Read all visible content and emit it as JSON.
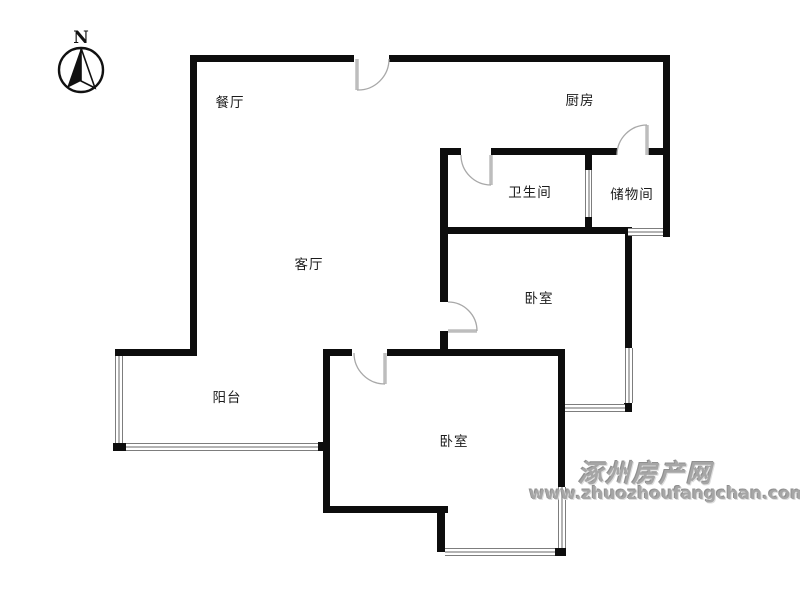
{
  "compass": {
    "label": "N"
  },
  "watermark": {
    "site_name": "涿州房产网",
    "site_url": "www.zhuozhoufangchan.com"
  },
  "colors": {
    "wall": "#0d0d0d",
    "window_frame": "#7d7d7d",
    "window_glass": "#b3b3b3",
    "door_leaf": "#bdbdbd",
    "door_arc": "#a8a8a8",
    "label_text": "#1c1c1c",
    "watermark_text": "#a6a6a6"
  },
  "rooms": [
    {
      "name": "dining-room",
      "label": "餐厅",
      "x": 230,
      "y": 101
    },
    {
      "name": "kitchen",
      "label": "厨房",
      "x": 580,
      "y": 99
    },
    {
      "name": "bathroom",
      "label": "卫生间",
      "x": 530,
      "y": 191
    },
    {
      "name": "storage-room",
      "label": "储物间",
      "x": 632,
      "y": 193
    },
    {
      "name": "living-room",
      "label": "客厅",
      "x": 309,
      "y": 263
    },
    {
      "name": "bedroom-east",
      "label": "卧室",
      "x": 539,
      "y": 297
    },
    {
      "name": "balcony",
      "label": "阳台",
      "x": 227,
      "y": 396
    },
    {
      "name": "bedroom-south",
      "label": "卧室",
      "x": 454,
      "y": 440
    }
  ],
  "plan": {
    "walls": [
      {
        "name": "top-wall-west",
        "x": 193,
        "y": 55,
        "w": 161,
        "h": 7
      },
      {
        "name": "top-wall-east",
        "x": 389,
        "y": 55,
        "w": 281,
        "h": 7
      },
      {
        "name": "west-wall",
        "x": 190,
        "y": 55,
        "w": 7,
        "h": 301
      },
      {
        "name": "east-outer-wall",
        "x": 663,
        "y": 55,
        "w": 7,
        "h": 182
      },
      {
        "name": "kitchen-wall-west",
        "x": 440,
        "y": 148,
        "w": 21,
        "h": 7
      },
      {
        "name": "kitchen-wall-mid",
        "x": 491,
        "y": 148,
        "w": 126,
        "h": 7
      },
      {
        "name": "kitchen-wall-east",
        "x": 647,
        "y": 148,
        "w": 23,
        "h": 7
      },
      {
        "name": "hall-divider-upper",
        "x": 440,
        "y": 148,
        "w": 8,
        "h": 154
      },
      {
        "name": "hall-divider-lower",
        "x": 440,
        "y": 331,
        "w": 8,
        "h": 25
      },
      {
        "name": "bath-south-wall",
        "x": 440,
        "y": 227,
        "w": 188,
        "h": 7
      },
      {
        "name": "bath-storage-divider-upper",
        "x": 585,
        "y": 152,
        "w": 7,
        "h": 18
      },
      {
        "name": "bath-storage-divider-lower",
        "x": 585,
        "y": 217,
        "w": 7,
        "h": 17
      },
      {
        "name": "bedroom-east-wall",
        "x": 625,
        "y": 227,
        "w": 7,
        "h": 121
      },
      {
        "name": "bay-corner-post",
        "x": 624,
        "y": 403,
        "w": 8,
        "h": 9
      },
      {
        "name": "balcony-north-wall",
        "x": 115,
        "y": 349,
        "w": 82,
        "h": 7
      },
      {
        "name": "south-wall-west",
        "x": 323,
        "y": 349,
        "w": 29,
        "h": 7
      },
      {
        "name": "south-wall-east",
        "x": 387,
        "y": 349,
        "w": 178,
        "h": 7
      },
      {
        "name": "mid-east-wall",
        "x": 558,
        "y": 349,
        "w": 7,
        "h": 138
      },
      {
        "name": "bedroom2-west-wall",
        "x": 323,
        "y": 349,
        "w": 7,
        "h": 164
      },
      {
        "name": "bedroom2-south-wall",
        "x": 323,
        "y": 506,
        "w": 125,
        "h": 7
      },
      {
        "name": "bay2-west-wall",
        "x": 437,
        "y": 506,
        "w": 8,
        "h": 46
      },
      {
        "name": "bay2-corner-post",
        "x": 555,
        "y": 548,
        "w": 11,
        "h": 8
      },
      {
        "name": "balcony-corner-sw",
        "x": 113,
        "y": 443,
        "w": 13,
        "h": 8
      },
      {
        "name": "balcony-corner-se",
        "x": 318,
        "y": 442,
        "w": 12,
        "h": 9
      }
    ],
    "windows": [
      {
        "name": "balcony-west-window",
        "x": 115,
        "y": 356,
        "w": 8,
        "h": 87,
        "dir": "v"
      },
      {
        "name": "balcony-south-window",
        "x": 126,
        "y": 443,
        "w": 192,
        "h": 8,
        "dir": "h"
      },
      {
        "name": "storage-south-window",
        "x": 628,
        "y": 228,
        "w": 35,
        "h": 8,
        "dir": "h"
      },
      {
        "name": "bay-east-window",
        "x": 625,
        "y": 348,
        "w": 8,
        "h": 55,
        "dir": "v"
      },
      {
        "name": "bay-south-window",
        "x": 565,
        "y": 404,
        "w": 60,
        "h": 8,
        "dir": "h"
      },
      {
        "name": "bay2-east-window",
        "x": 558,
        "y": 487,
        "w": 8,
        "h": 61,
        "dir": "v"
      },
      {
        "name": "bay2-south-window",
        "x": 445,
        "y": 548,
        "w": 110,
        "h": 8,
        "dir": "h"
      },
      {
        "name": "bath-storage-window",
        "x": 585,
        "y": 170,
        "w": 7,
        "h": 47,
        "dir": "v"
      }
    ],
    "doors": [
      {
        "name": "entry-door",
        "arc": "M 389 59 A 31 31 0 0 1 357 90",
        "leaf": "M 357 59 L 357 90"
      },
      {
        "name": "bathroom-door",
        "arc": "M 461 155 A 30 30 0 0 0 491 185",
        "leaf": "M 491 155 L 491 185"
      },
      {
        "name": "storage-door",
        "arc": "M 617 155 A 30 30 0 0 1 647 125",
        "leaf": "M 647 155 L 647 125"
      },
      {
        "name": "bedroom-east-door",
        "arc": "M 448 302 A 29 29 0 0 1 477 331",
        "leaf": "M 448 331 L 477 331"
      },
      {
        "name": "bedroom-south-door",
        "arc": "M 354 353 A 31 31 0 0 0 385 384",
        "leaf": "M 385 353 L 385 384"
      }
    ]
  }
}
